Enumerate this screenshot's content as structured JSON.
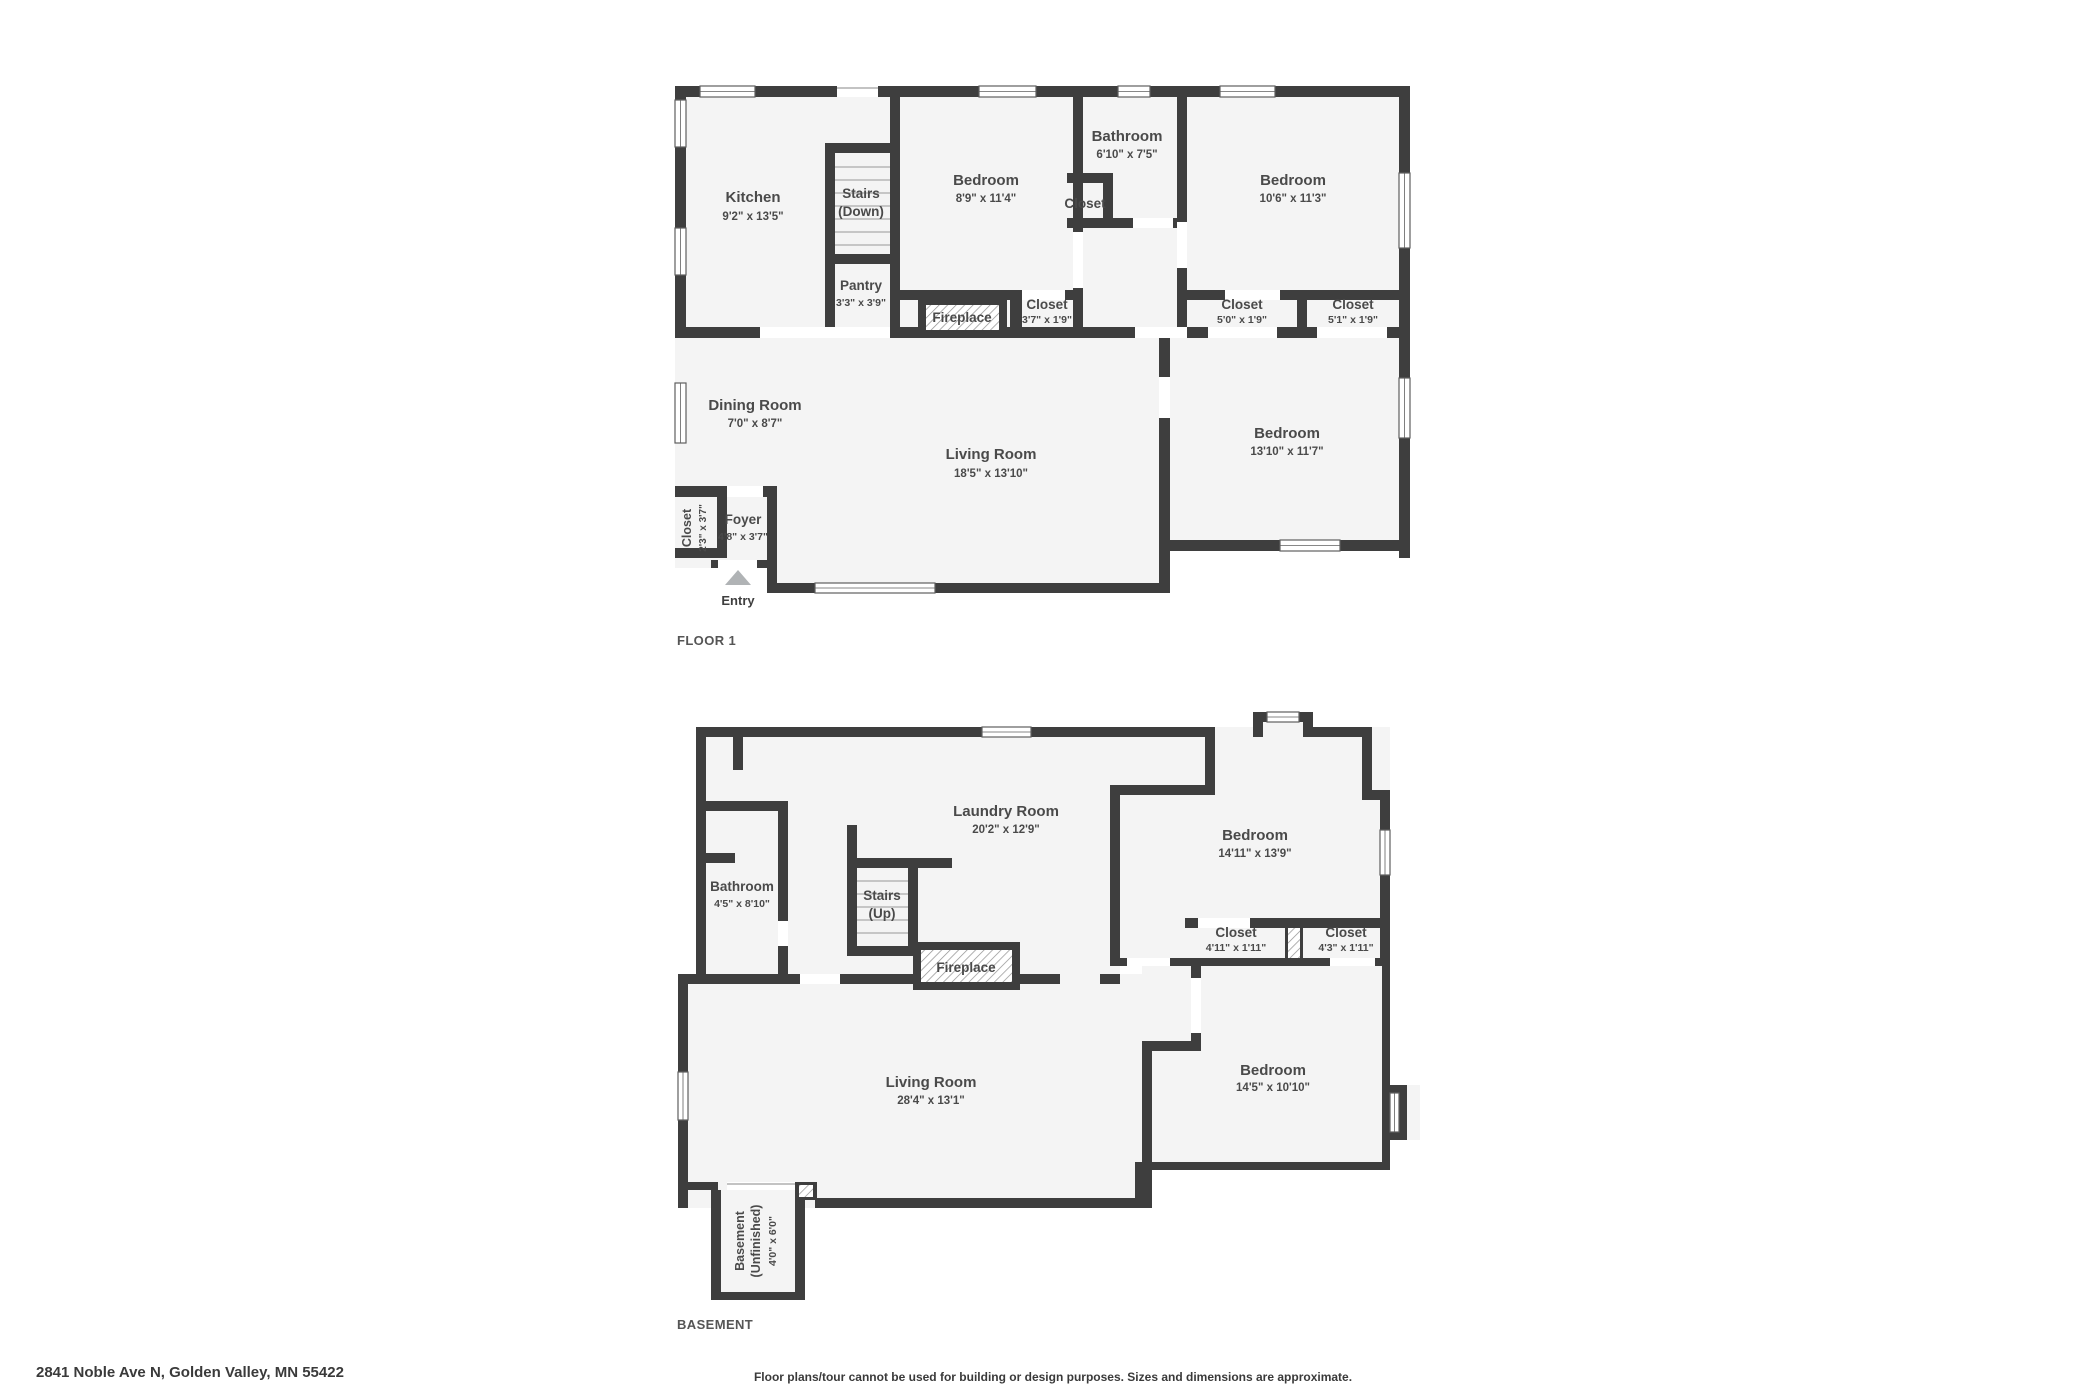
{
  "colors": {
    "wall": "#3e3e3e",
    "floor": "#f4f4f4",
    "label": "#4a4a4a",
    "arrow": "#b0b3b5"
  },
  "page": {
    "address": "2841 Noble Ave N, Golden Valley, MN 55422",
    "disclaimer": "Floor plans/tour cannot be used for building or design purposes. Sizes and dimensions are approximate."
  },
  "floor1": {
    "title": "FLOOR 1",
    "entry_label": "Entry",
    "rooms": {
      "kitchen": {
        "name": "Kitchen",
        "dims": "9'2\" x 13'5\""
      },
      "stairs": {
        "name": "Stairs",
        "dims": "(Down)"
      },
      "pantry": {
        "name": "Pantry",
        "dims": "3'3\" x 3'9\""
      },
      "bedroom1": {
        "name": "Bedroom",
        "dims": "8'9\" x 11'4\""
      },
      "bathroom": {
        "name": "Bathroom",
        "dims": "6'10\" x 7'5\""
      },
      "bath_closet": {
        "name": "Closet"
      },
      "bedroom2": {
        "name": "Bedroom",
        "dims": "10'6\" x 11'3\""
      },
      "fireplace": {
        "name": "Fireplace"
      },
      "closet1": {
        "name": "Closet",
        "dims": "3'7\" x 1'9\""
      },
      "closet2": {
        "name": "Closet",
        "dims": "5'0\" x 1'9\""
      },
      "closet3": {
        "name": "Closet",
        "dims": "5'1\" x 1'9\""
      },
      "dining": {
        "name": "Dining Room",
        "dims": "7'0\" x 8'7\""
      },
      "living": {
        "name": "Living Room",
        "dims": "18'5\" x 13'10\""
      },
      "bedroom3": {
        "name": "Bedroom",
        "dims": "13'10\" x 11'7\""
      },
      "foyer_closet": {
        "name": "Closet",
        "dims": "2'3\" x 3'7\""
      },
      "foyer": {
        "name": "Foyer",
        "dims": "4'8\" x 3'7\""
      }
    }
  },
  "basement": {
    "title": "BASEMENT",
    "rooms": {
      "laundry": {
        "name": "Laundry Room",
        "dims": "20'2\" x 12'9\""
      },
      "bathroom": {
        "name": "Bathroom",
        "dims": "4'5\" x 8'10\""
      },
      "stairs": {
        "name": "Stairs",
        "dims": "(Up)"
      },
      "fireplace": {
        "name": "Fireplace"
      },
      "bedroom1": {
        "name": "Bedroom",
        "dims": "14'11\" x 13'9\""
      },
      "closet1": {
        "name": "Closet",
        "dims": "4'11\" x 1'11\""
      },
      "closet2": {
        "name": "Closet",
        "dims": "4'3\" x 1'11\""
      },
      "living": {
        "name": "Living Room",
        "dims": "28'4\" x 13'1\""
      },
      "bedroom2": {
        "name": "Bedroom",
        "dims": "14'5\" x 10'10\""
      },
      "unfinished": {
        "name": "Basement",
        "name2": "(Unfinished)",
        "dims": "4'0\" x 6'0\""
      }
    }
  }
}
